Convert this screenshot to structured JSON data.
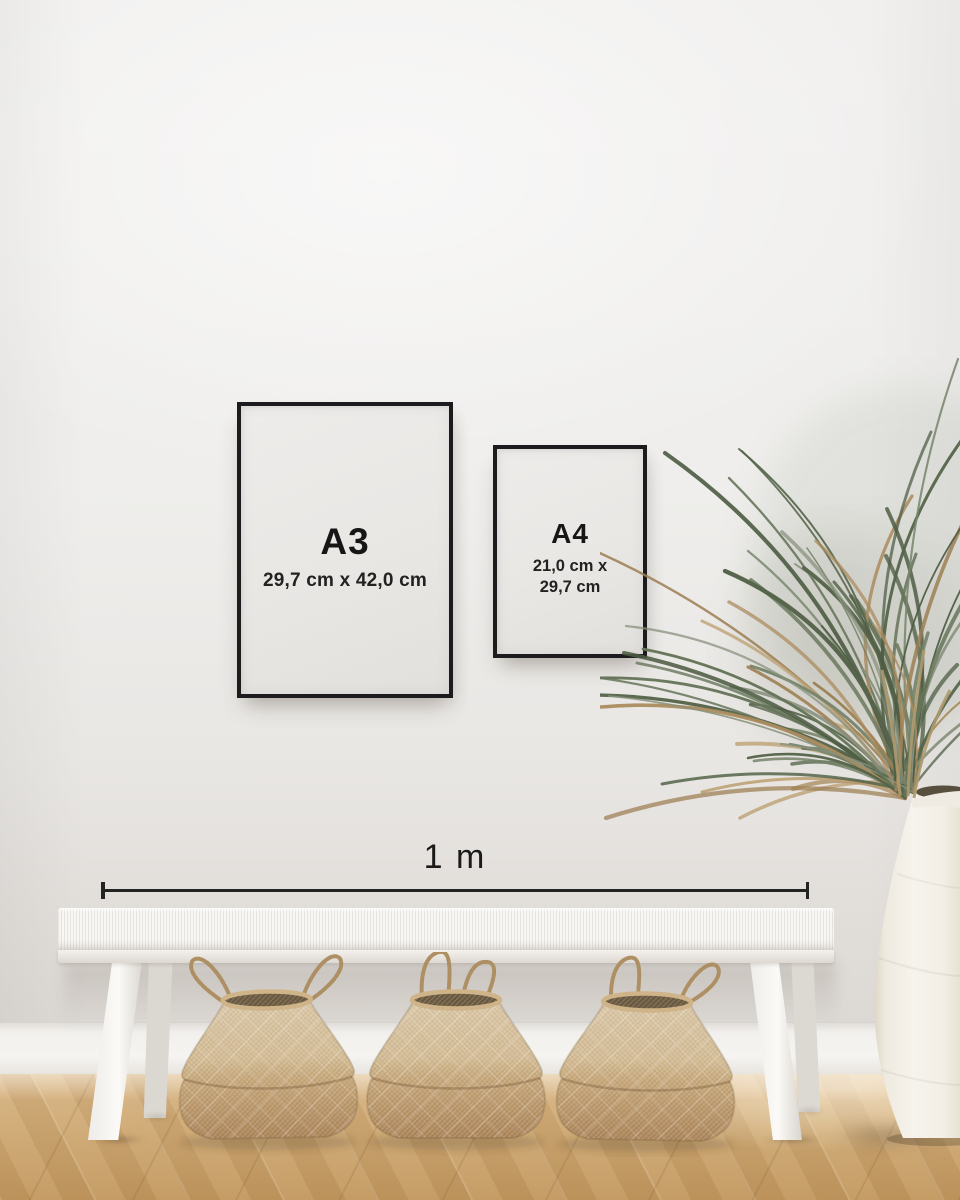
{
  "frames": {
    "a3": {
      "label": "A3",
      "dimensions": "29,7 cm x 42,0 cm"
    },
    "a4": {
      "label": "A4",
      "dimensions_line1": "21,0 cm x",
      "dimensions_line2": "29,7 cm"
    }
  },
  "scale": {
    "label": "1 m"
  },
  "palette": {
    "wall": "#efeeec",
    "baseboard": "#f4f2ef",
    "floor_light": "#dcba8b",
    "floor_dark": "#c2975f",
    "frame_black": "#1c1c1e",
    "poster_white": "#e9e7e4",
    "text_dark": "#161616",
    "bench_white": "#f5f3f0",
    "basket_light": "#d8c4a3",
    "basket_dark": "#b9946a",
    "plant_green": "#66755a",
    "plant_green_dark": "#4d5c43",
    "plant_green_light": "#87907c",
    "plant_dried": "#ab8b5e",
    "vase_white": "#f2eee6"
  }
}
